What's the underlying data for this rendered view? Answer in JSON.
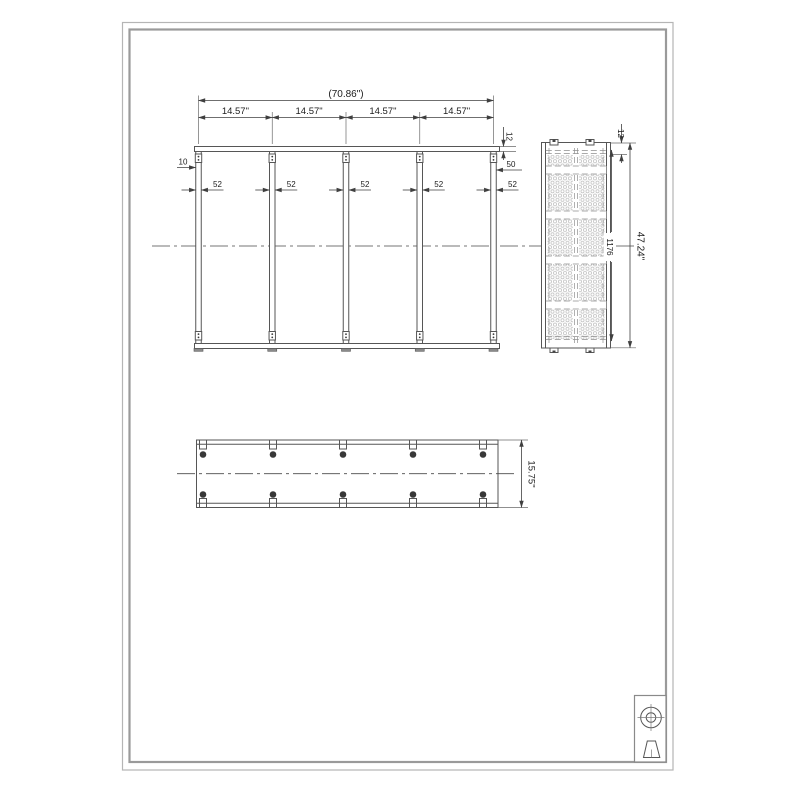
{
  "front_view": {
    "overall_width": "(70.86\")",
    "bay_widths": [
      "14.57\"",
      "14.57\"",
      "14.57\"",
      "14.57\""
    ],
    "shelf_thickness": "12",
    "left_offset": "10",
    "right_offset": "50",
    "post_widths": [
      "52",
      "52",
      "52",
      "52",
      "52"
    ]
  },
  "side_view": {
    "top_thickness": "12",
    "inner_height": "1176",
    "overall_height": "47.24\""
  },
  "bottom_view": {
    "overall_depth": "15.75\""
  },
  "icons": {
    "title_block": [
      "leveler-top-icon",
      "leveler-front-icon"
    ]
  },
  "colors": {
    "part_line": "#565656",
    "dimension_line": "#3f3f3f",
    "frame": "#9a9a9a",
    "mesh": "#c4c4c4",
    "hole_dot": "#383838"
  }
}
